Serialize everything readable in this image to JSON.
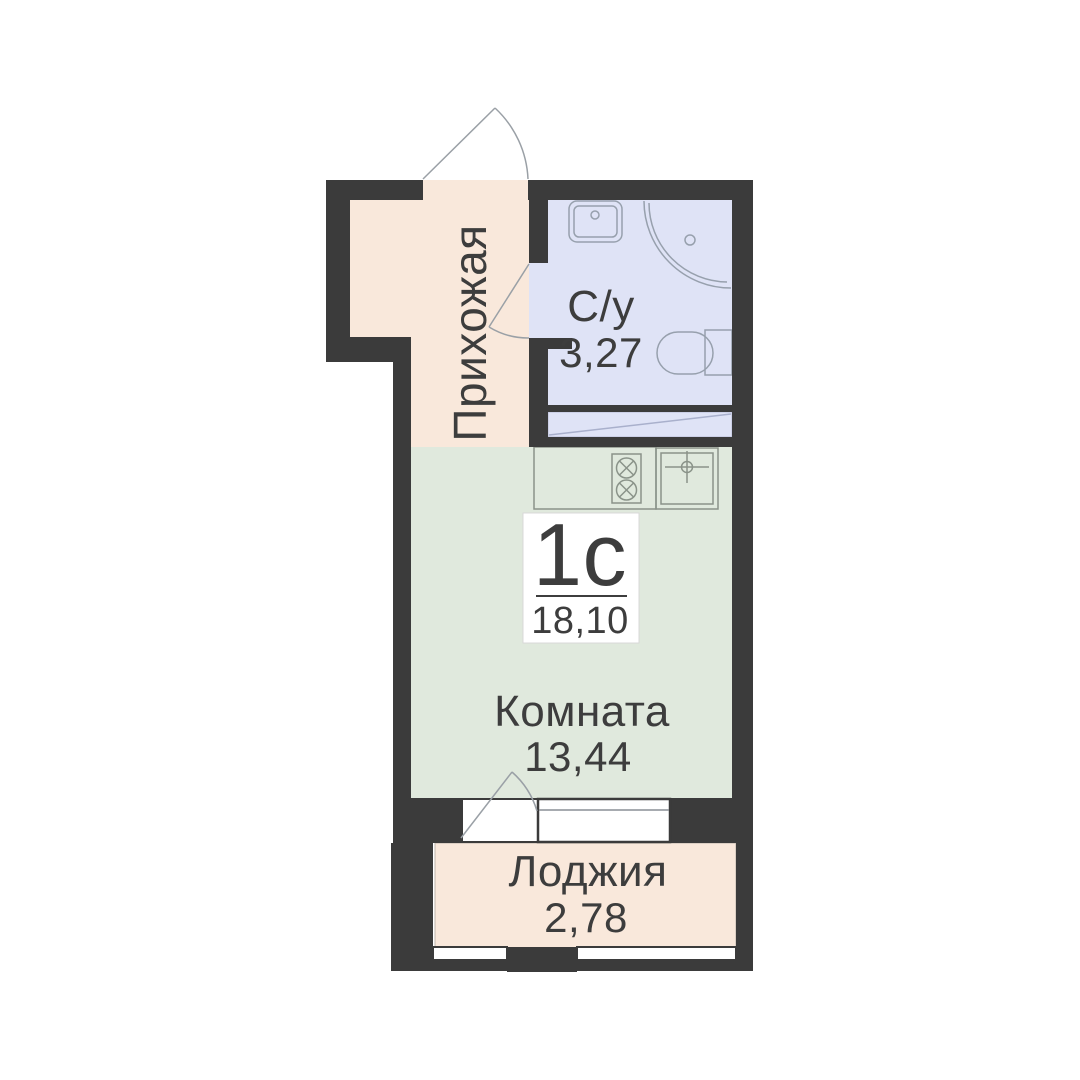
{
  "plan": {
    "apartment_type": "1с",
    "total_area": "18,10",
    "rooms": {
      "hallway": {
        "label": "Прихожая"
      },
      "bathroom": {
        "label": "С/у",
        "area": "3,27"
      },
      "living": {
        "label": "Комната",
        "area": "13,44"
      },
      "loggia": {
        "label": "Лоджия",
        "area": "2,78"
      }
    },
    "icons": {
      "bathroom": [
        "washbasin-icon",
        "shower-icon",
        "toilet-icon"
      ],
      "kitchen": [
        "stove-icon",
        "kitchen-sink-icon"
      ],
      "doors": [
        "entry-door-swing-icon",
        "bathroom-door-swing-icon",
        "balcony-door-swing-icon"
      ]
    },
    "colors": {
      "wall": "#3b3b3b",
      "hallway_floor": "#f9e8db",
      "bathroom_floor": "#dfe3f6",
      "room_floor": "#e0e9dd",
      "loggia_floor": "#f9e8db",
      "window_fill": "#ffffff",
      "fixture_line": "#97a0ad",
      "text": "#3d3d3d"
    }
  }
}
